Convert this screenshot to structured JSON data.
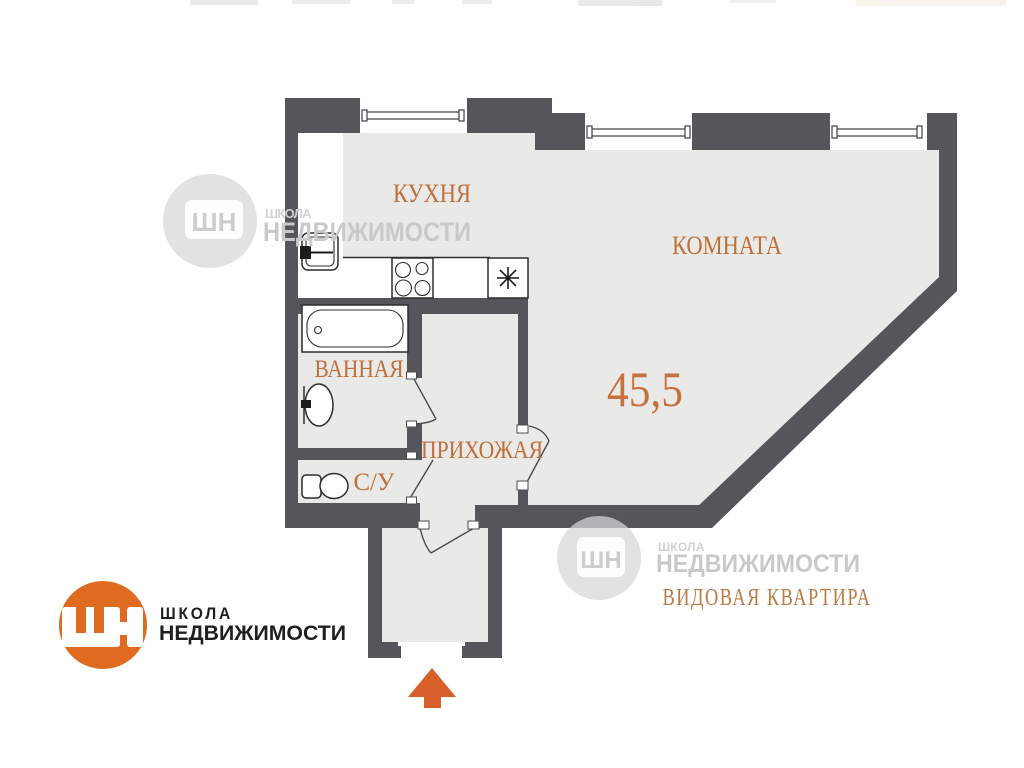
{
  "plan": {
    "area_value": "45,5",
    "labels": {
      "kitchen": "КУХНЯ",
      "living_room": "КОМНАТА",
      "bathroom": "ВАННАЯ",
      "wc": "С/У",
      "hallway": "ПРИХОЖАЯ"
    },
    "caption": "ВИДОВАЯ КВАРТИРА"
  },
  "branding": {
    "monogram": "ШН",
    "word_top": "ШКОЛА",
    "word_bottom": "НЕДВИЖИМОСТИ"
  },
  "colors": {
    "wall": "#54565a",
    "floor": "#e9e9e7",
    "label_orange": "#bf6f3a",
    "area_orange": "#c8703c",
    "caption_orange": "#b87b46",
    "logo_orange": "#df6b21",
    "arrow_orange": "#d95f2a",
    "watermark_gray": "#cccccc"
  }
}
